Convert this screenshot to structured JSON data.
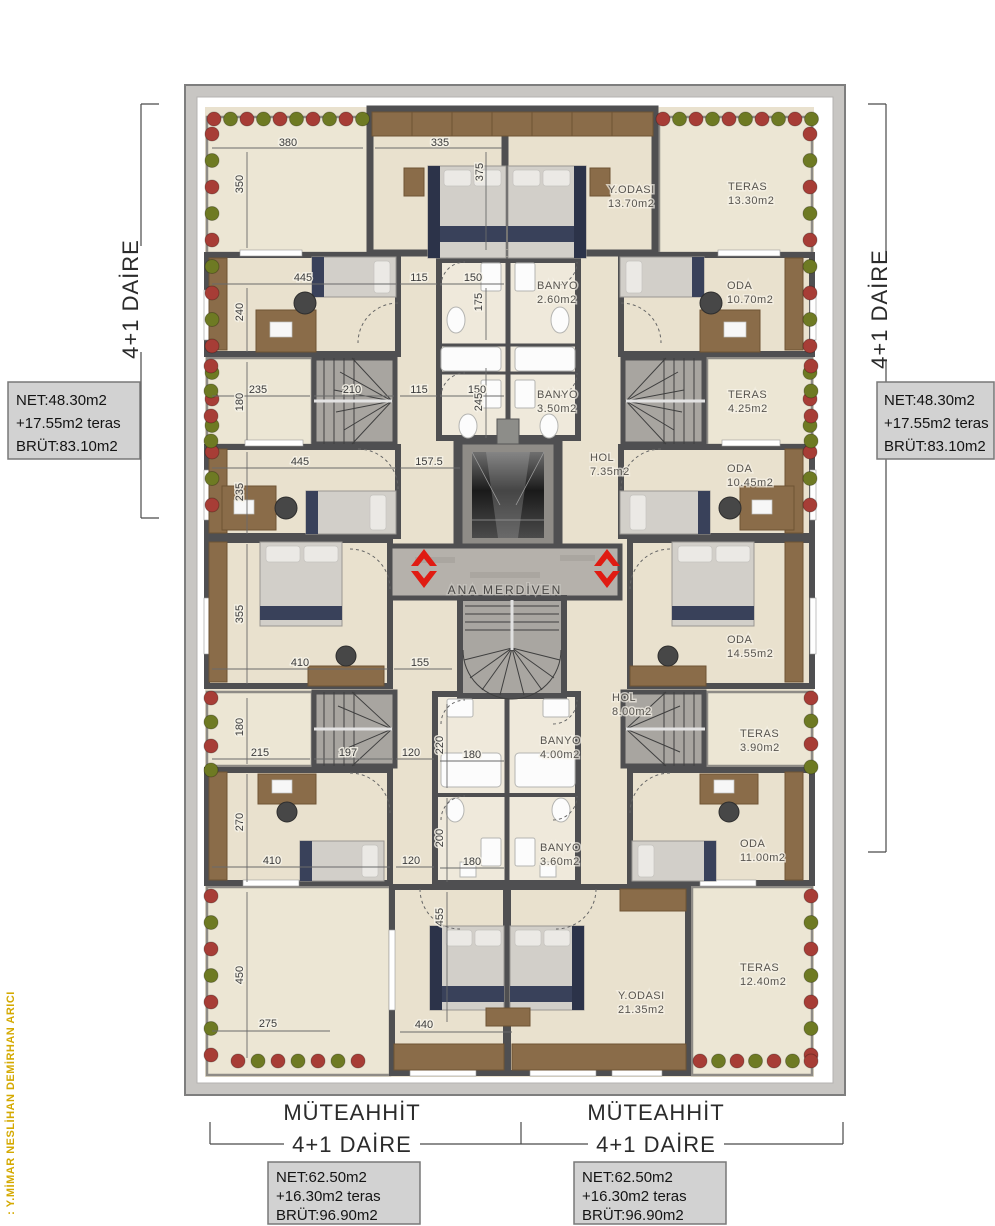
{
  "colors": {
    "accent_red": "#e01b12",
    "bush_red": "#a73d36",
    "bush_green": "#6e7a23",
    "gold": "#d4a900",
    "wall": "#4f4f51",
    "wood": "#d9bc90",
    "marble": "#ece6d4",
    "box_bg": "#d2d2d2"
  },
  "architect_credit": ": Y.MİMAR NESLİHAN DEMİRHAN ARICI",
  "stair_core_label": "ANA MERDİVEN",
  "unit_left": {
    "type": "4+1 DAİRE",
    "net": "NET:48.30m2",
    "terrace": "+17.55m2 teras",
    "gross": "BRÜT:83.10m2"
  },
  "unit_right": {
    "type": "4+1 DAİRE",
    "net": "NET:48.30m2",
    "terrace": "+17.55m2 teras",
    "gross": "BRÜT:83.10m2"
  },
  "unit_bottom_left": {
    "builder": "MÜTEAHHİT",
    "type": "4+1 DAİRE",
    "net": "NET:62.50m2",
    "terrace": "+16.30m2 teras",
    "gross": "BRÜT:96.90m2"
  },
  "unit_bottom_right": {
    "builder": "MÜTEAHHİT",
    "type": "4+1 DAİRE",
    "net": "NET:62.50m2",
    "terrace": "+16.30m2 teras",
    "gross": "BRÜT:96.90m2"
  },
  "rooms": [
    {
      "name": "Y.ODASI",
      "area": "13.70m2"
    },
    {
      "name": "TERAS",
      "area": "13.30m2"
    },
    {
      "name": "BANYO",
      "area": "2.60m2"
    },
    {
      "name": "ODA",
      "area": "10.70m2"
    },
    {
      "name": "BANYO",
      "area": "3.50m2"
    },
    {
      "name": "TERAS",
      "area": "4.25m2"
    },
    {
      "name": "HOL",
      "area": "7.35m2"
    },
    {
      "name": "ODA",
      "area": "10.45m2"
    },
    {
      "name": "ODA",
      "area": "14.55m2"
    },
    {
      "name": "HOL",
      "area": "8.00m2"
    },
    {
      "name": "TERAS",
      "area": "3.90m2"
    },
    {
      "name": "BANYO",
      "area": "4.00m2"
    },
    {
      "name": "BANYO",
      "area": "3.60m2"
    },
    {
      "name": "ODA",
      "area": "11.00m2"
    },
    {
      "name": "Y.ODASI",
      "area": "21.35m2"
    },
    {
      "name": "TERAS",
      "area": "12.40m2"
    }
  ],
  "dims": [
    "380",
    "350",
    "335",
    "375",
    "445",
    "115",
    "150",
    "240",
    "175",
    "235",
    "180",
    "210",
    "115",
    "150",
    "245",
    "445",
    "157.5",
    "235",
    "355",
    "410",
    "155",
    "180",
    "215",
    "197",
    "120",
    "220",
    "180",
    "270",
    "410",
    "120",
    "200",
    "180",
    "450",
    "275",
    "440",
    "455"
  ]
}
